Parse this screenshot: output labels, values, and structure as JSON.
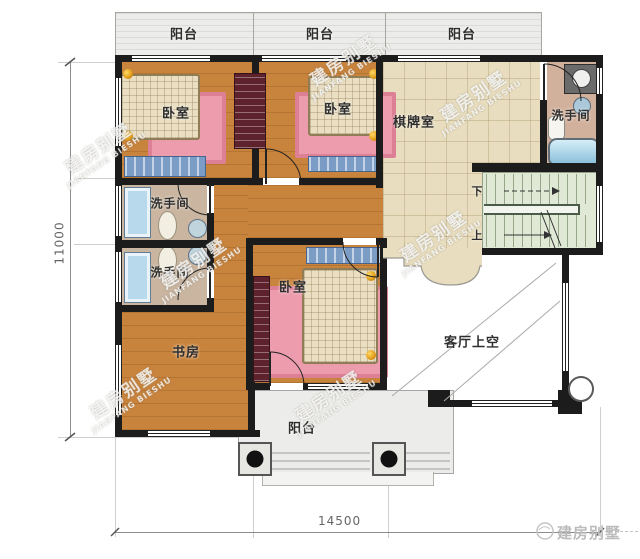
{
  "labels": {
    "balcony_top_1": "阳台",
    "balcony_top_2": "阳台",
    "balcony_top_3": "阳台",
    "balcony_bottom": "阳台",
    "bedroom_1": "卧室",
    "bedroom_2": "卧室",
    "bedroom_3": "卧室",
    "chess_room": "棋牌室",
    "bath_main": "洗手间",
    "bath_left_upper": "洗手间",
    "bath_left_lower": "洗手间",
    "study": "书房",
    "living_void": "客厅上空",
    "stair_down": "下",
    "stair_up": "上"
  },
  "dimensions": {
    "total_width": "14500",
    "total_height": "11000"
  },
  "watermark": {
    "cn": "建房别墅",
    "en": "JIANFANG BIESHU"
  },
  "brand": {
    "logo_text": "建房别墅"
  },
  "colors": {
    "wall": "#1c1c1c",
    "wood_floor": "#c8833c",
    "tile_floor": "#e8ddbe",
    "bath_floor": "#c9b5a0",
    "stair_floor": "#e0e9d6",
    "mat_pink": "#ec9cad",
    "rug_blue": "#7b9cc4",
    "wardrobe_red": "#5e222c",
    "tub_blue": "#86bcd8"
  }
}
